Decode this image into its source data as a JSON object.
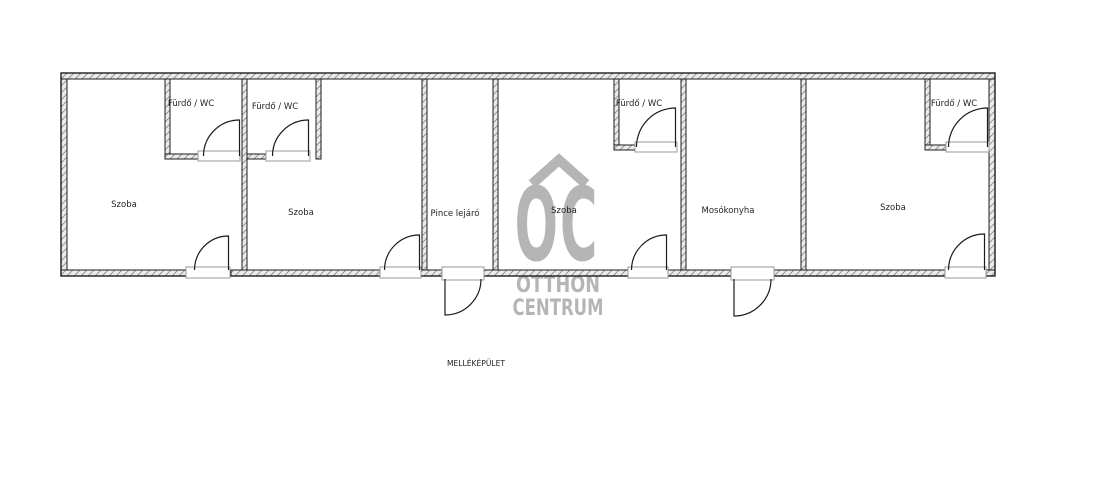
{
  "plan": {
    "footer_label": "MELLÉKÉPÜLET",
    "rooms": [
      {
        "name": "szoba-1",
        "label": "Szoba"
      },
      {
        "name": "furdo-wc-1",
        "label": "Fürdő / WC"
      },
      {
        "name": "furdo-wc-2",
        "label": "Fürdő / WC"
      },
      {
        "name": "szoba-2",
        "label": "Szoba"
      },
      {
        "name": "pince-lejaro",
        "label": "Pince lejáró"
      },
      {
        "name": "szoba-3",
        "label": "Szoba"
      },
      {
        "name": "furdo-wc-3",
        "label": "Fürdő / WC"
      },
      {
        "name": "mosokonyha",
        "label": "Mosókonyha"
      },
      {
        "name": "szoba-4",
        "label": "Szoba"
      },
      {
        "name": "furdo-wc-4",
        "label": "Fürdő / WC"
      }
    ],
    "watermark": {
      "logo_letters": "OC",
      "line1": "OTTHON",
      "line2": "CENTRUM"
    },
    "colors": {
      "line": "#1c1c1c",
      "wall_fill": "#ebebeb",
      "wall_hatch": "#8c8c8c",
      "watermark": "#b5b5b5",
      "label_text": "#1f1f1f"
    }
  }
}
